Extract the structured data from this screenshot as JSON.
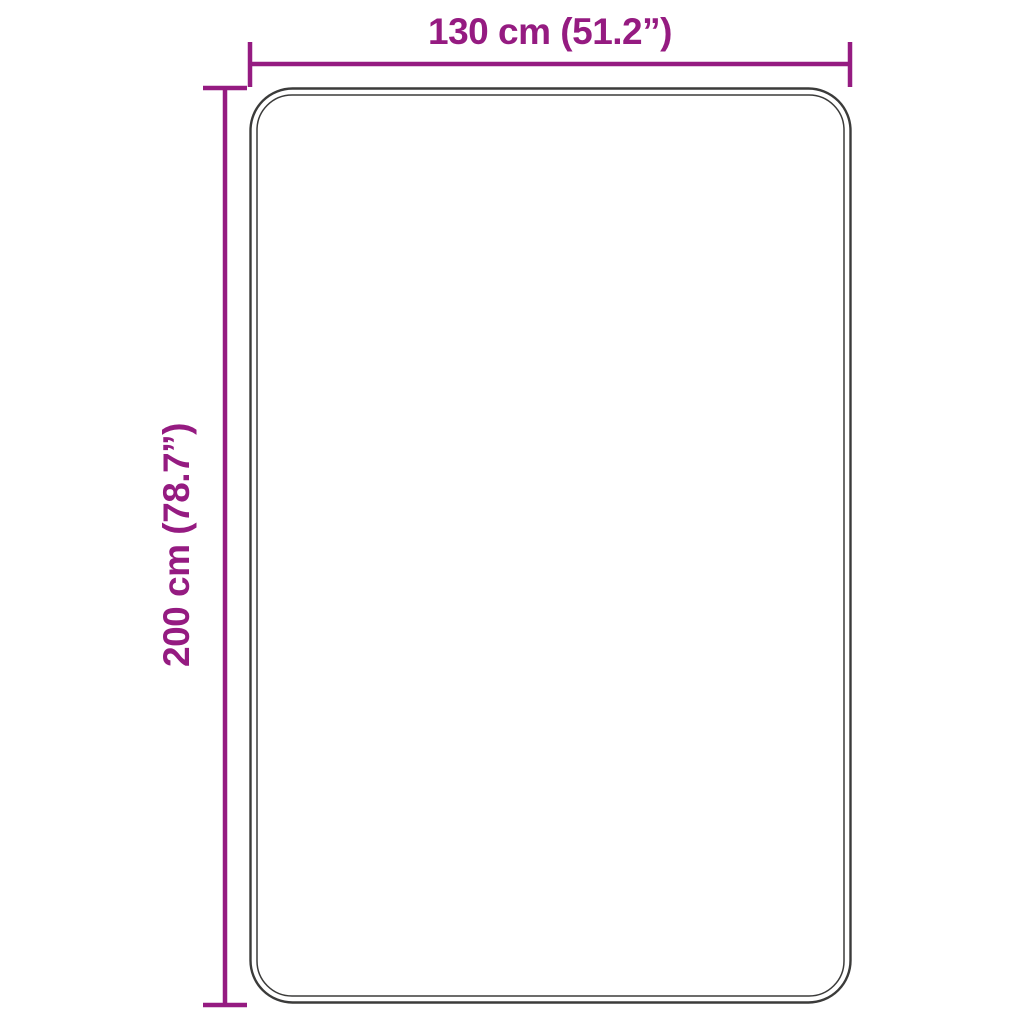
{
  "diagram": {
    "type": "product-dimension-diagram",
    "width_label": "130 cm (51.2”)",
    "height_label": "200 cm (78.7”)",
    "width_cm": 130,
    "width_inches": 51.2,
    "height_cm": 200,
    "height_inches": 78.7,
    "colors": {
      "dimension": "#951b81",
      "outline": "#3b3b3a",
      "background": "#ffffff"
    }
  }
}
